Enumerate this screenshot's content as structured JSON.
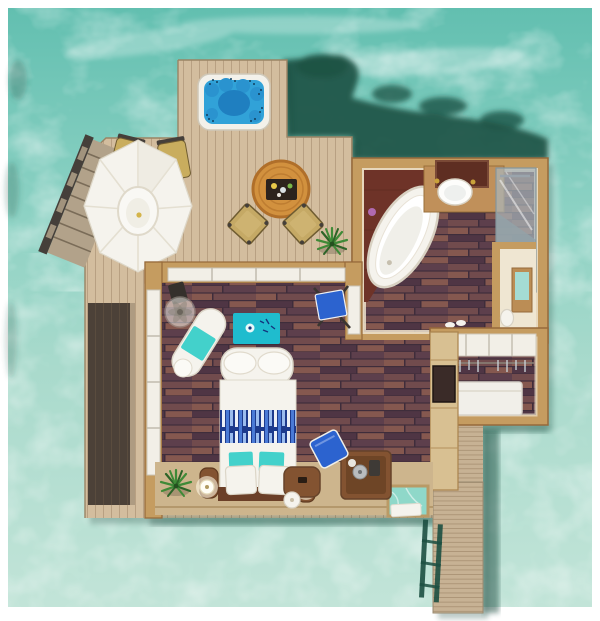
{
  "scene": {
    "description": "Top-down 3D rendered floor plan of an overwater pool villa surrounded by turquoise lagoon water",
    "rooms": [
      "sun-deck-terrace",
      "bedroom",
      "bathroom",
      "toilet-room",
      "wardrobe",
      "jetty-walkway"
    ],
    "features": [
      "hot tub jacuzzi with blue water and seat jets",
      "octagonal white sun umbrella over two sun loungers",
      "round rattan dining table with serving tray and two director chairs",
      "sea-access stairs with dark handrail",
      "king bed with white duvet, blue patterned runner, teal and white pillows",
      "curved white bench at foot of bed",
      "white chaise lounge with teal towel",
      "pedestal fan",
      "teal area rug",
      "blue easel chair and wooden desk chairs with minibar caddy",
      "two glowing bedside lamps on wooden side tables",
      "two potted green plants",
      "glass floor viewing panel with white towel",
      "freestanding oval bathtub on dark wood corner platform",
      "vanity counter with round sink, gold taps and dark wood mirror",
      "walk-in glass shower",
      "toilet room with mirrored cabinet",
      "wardrobe with white overhead cabinets, hanging rail and white storage chest",
      "tall wooden TV cabinet column",
      "plank jetty walkway with green swim ladder",
      "dark seagrass patches in the lagoon"
    ]
  },
  "colors": {
    "ocean_top": "#62bfb0",
    "ocean_mid": "#8ed2c4",
    "ocean_low": "#a9dacc",
    "ocean_bottom": "#c2e4d8",
    "foam": "#ffffff",
    "seagrass": "#1d5244",
    "shadow_teal": "#14463a",
    "deck": "#d3bd9e",
    "plank_line": "#8a6f52",
    "walkway": "#c7b294",
    "wall": "#c59c60",
    "wall_edge": "#96693a",
    "door_white": "#f2efe7",
    "floor_base": "#3f2d3b",
    "floor_p1": "#714b4d",
    "floor_p2": "#5d3f4c",
    "floor_p3": "#85584f",
    "floor_p4": "#4f3544",
    "fixture_white": "#f5f3ed",
    "fixture_shade": "#d9d3c4",
    "teal": "#43d1cb",
    "rug_teal": "#1fbcce",
    "hot_tub_rim": "#f3f1ea",
    "hot_tub_water": "#31a2d8",
    "hot_tub_deep": "#1f7fc0",
    "jet_dot": "#123f5e",
    "table_orange": "#d2913e",
    "table_ring": "#b06f2a",
    "tray_dark": "#2c231d",
    "chair_khaki": "#c5a965",
    "chair_edge": "#6f5c31",
    "lounger": "#c9ad5e",
    "blue_chair": "#2c63cf",
    "runner_dark": "#1d3a8c",
    "runner_mid": "#4a7ad6",
    "runner_light": "#9bbcee",
    "wood_brown": "#835331",
    "wood_brown_dark": "#5f3a20",
    "platform_tan": "#cdb58d",
    "recess_dark": "#4c4138",
    "glass_water": "#8fd8c9",
    "plant_green": "#3f8a37",
    "plant_dark": "#2d6427",
    "mirror_brown": "#5e2e22",
    "shower_glass": "#a9b6ba",
    "lamp_glow": "#fdf6e3",
    "tub_platform": "#6e3328",
    "steps_wood": "#b2a28a",
    "rail_dark": "#453f3a",
    "metal_gray": "#b9bcbe",
    "cream_wall": "#ece2cc",
    "chest_white": "#f1efe9",
    "hanger_gray": "#c6cdd2",
    "toilet_cream": "#efe6d2",
    "ladder_green": "#1c4f41"
  }
}
